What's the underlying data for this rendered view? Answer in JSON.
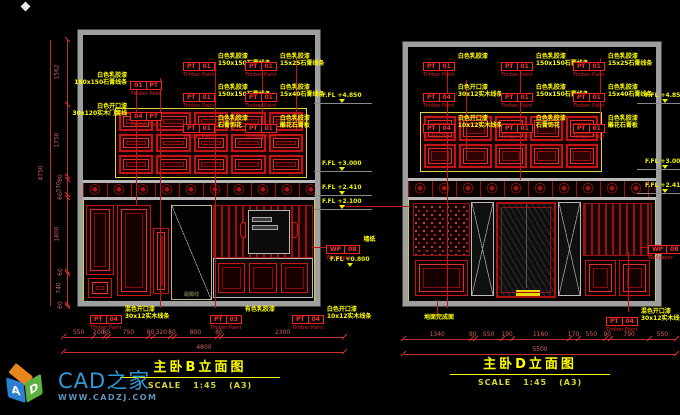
{
  "colors": {
    "cad_red": "#c41414",
    "annotation_yellow": "#ffff00",
    "frame_gray": "#9f9f9f",
    "brand_blue": "#2f9ad8",
    "level_yellow": "#f0f000"
  },
  "watermark": {
    "brand": "CAD之家",
    "url": "WWW.CADZJ.COM",
    "cube": {
      "left_letter": "A",
      "right_letter": "D"
    }
  },
  "left_view": {
    "title": "主卧B立面图",
    "scale": {
      "label": "SCALE",
      "ratio": "1:45",
      "sheet": "(A3)"
    },
    "callouts_left": [
      {
        "t1": "01",
        "t2": "PT",
        "sub": "Timber Paint",
        "line1": "白色乳胶漆",
        "line2": "150x150石膏线条"
      },
      {
        "t1": "04",
        "t2": "PT",
        "sub": "Timber Paint",
        "line1": "白色开口漆",
        "line2": "30x120实木门套线"
      }
    ],
    "callouts_mid": [
      {
        "t1": "PT",
        "t2": "01",
        "sub": "Timber Paint",
        "line1": "白色乳胶漆",
        "line2": "150x150石膏线条"
      },
      {
        "t1": "PT",
        "t2": "01",
        "sub": "Timber Paint",
        "line1": "白色乳胶漆",
        "line2": "150x150石膏线条"
      },
      {
        "t1": "PT",
        "t2": "01",
        "sub": "Timber Paint",
        "line1": "白色乳胶漆",
        "line2": "石膏饰花"
      }
    ],
    "callouts_right": [
      {
        "t1": "PT",
        "t2": "01",
        "sub": "Timber Paint",
        "line1": "白色乳胶漆",
        "line2": "15x25石膏线条"
      },
      {
        "t1": "PT",
        "t2": "01",
        "sub": "Timber Paint",
        "line1": "白色乳胶漆",
        "line2": "15x40石膏线条"
      },
      {
        "t1": "PT",
        "t2": "01",
        "sub": "Timber Paint",
        "line1": "白色乳胶漆",
        "line2": "雕花石膏板"
      }
    ],
    "callouts_bottom": [
      {
        "t1": "PT",
        "t2": "04",
        "sub": "Timber Paint",
        "line1": "混色开口漆",
        "line2": "30x12实木线条"
      },
      {
        "t1": "PT",
        "t2": "03",
        "sub": "Timber Paint",
        "line1": "有色乳胶漆",
        "line2": ""
      },
      {
        "t1": "PT",
        "t2": "04",
        "sub": "Timber Paint",
        "line1": "白色开口漆",
        "line2": "10x12实木线条"
      }
    ],
    "wallpaper": {
      "t1": "WP",
      "t2": "08",
      "sub": "Wallpaper",
      "note": "墙纸"
    },
    "levels": [
      "F.FL +4.850",
      "F.FL +3.000",
      "F.FL +2.410",
      "F.FL +2.100"
    ],
    "level_low": "F.FL +0.800",
    "door_note": "踢脚线",
    "vdims": [
      "1562",
      "1750",
      "80",
      "370",
      "60",
      "1800",
      "60",
      "740",
      "60"
    ],
    "vtotal": "4750",
    "hdims": [
      "550",
      "200",
      "80",
      "750",
      "80",
      "320",
      "80",
      "800",
      "80",
      "2300"
    ],
    "htotal": "4800"
  },
  "right_view": {
    "title": "主卧D立面图",
    "scale": {
      "label": "SCALE",
      "ratio": "1:45",
      "sheet": "(A3)"
    },
    "callouts_col1": [
      {
        "t1": "PT",
        "t2": "01",
        "sub": "Timber Paint",
        "line1": "白色乳胶漆",
        "line2": ""
      },
      {
        "t1": "PT",
        "t2": "04",
        "sub": "Timber Paint",
        "line1": "白色开口漆",
        "line2": "30x12实木线条"
      },
      {
        "t1": "PT",
        "t2": "04",
        "sub": "Timber Paint",
        "line1": "白色开口漆",
        "line2": "10x12实木线条"
      }
    ],
    "callouts_col2": [
      {
        "t1": "PT",
        "t2": "01",
        "sub": "Timber Paint",
        "line1": "白色乳胶漆",
        "line2": "150x150石膏线条"
      },
      {
        "t1": "PT",
        "t2": "01",
        "sub": "Timber Paint",
        "line1": "白色乳胶漆",
        "line2": "150x150石膏线条"
      },
      {
        "t1": "PT",
        "t2": "01",
        "sub": "Timber Paint",
        "line1": "白色乳胶漆",
        "line2": "石膏饰花"
      }
    ],
    "callouts_col3": [
      {
        "t1": "PT",
        "t2": "01",
        "sub": "Timber Paint",
        "line1": "白色乳胶漆",
        "line2": "15x25石膏线条"
      },
      {
        "t1": "PT",
        "t2": "01",
        "sub": "Timber Paint",
        "line1": "白色乳胶漆",
        "line2": "15x40石膏线条"
      },
      {
        "t1": "PT",
        "t2": "01",
        "sub": "Timber Paint",
        "line1": "白色乳胶漆",
        "line2": "雕花石膏板"
      }
    ],
    "callout_bottom": {
      "t1": "PT",
      "t2": "04",
      "sub": "Timber Paint",
      "line1": "混色开口漆",
      "line2": "30x12实木线条"
    },
    "floor_note": "地面完成面",
    "wallpaper": {
      "t1": "WP",
      "t2": "08",
      "sub": "Wallpaper"
    },
    "levels": [
      "F.FL +4.850",
      "F.FL +3.000",
      "F.FL +2.410"
    ],
    "hdims": [
      "1340",
      "90",
      "550",
      "190",
      "1160",
      "170",
      "550",
      "90",
      "790",
      "550"
    ],
    "htotal": "5500"
  }
}
